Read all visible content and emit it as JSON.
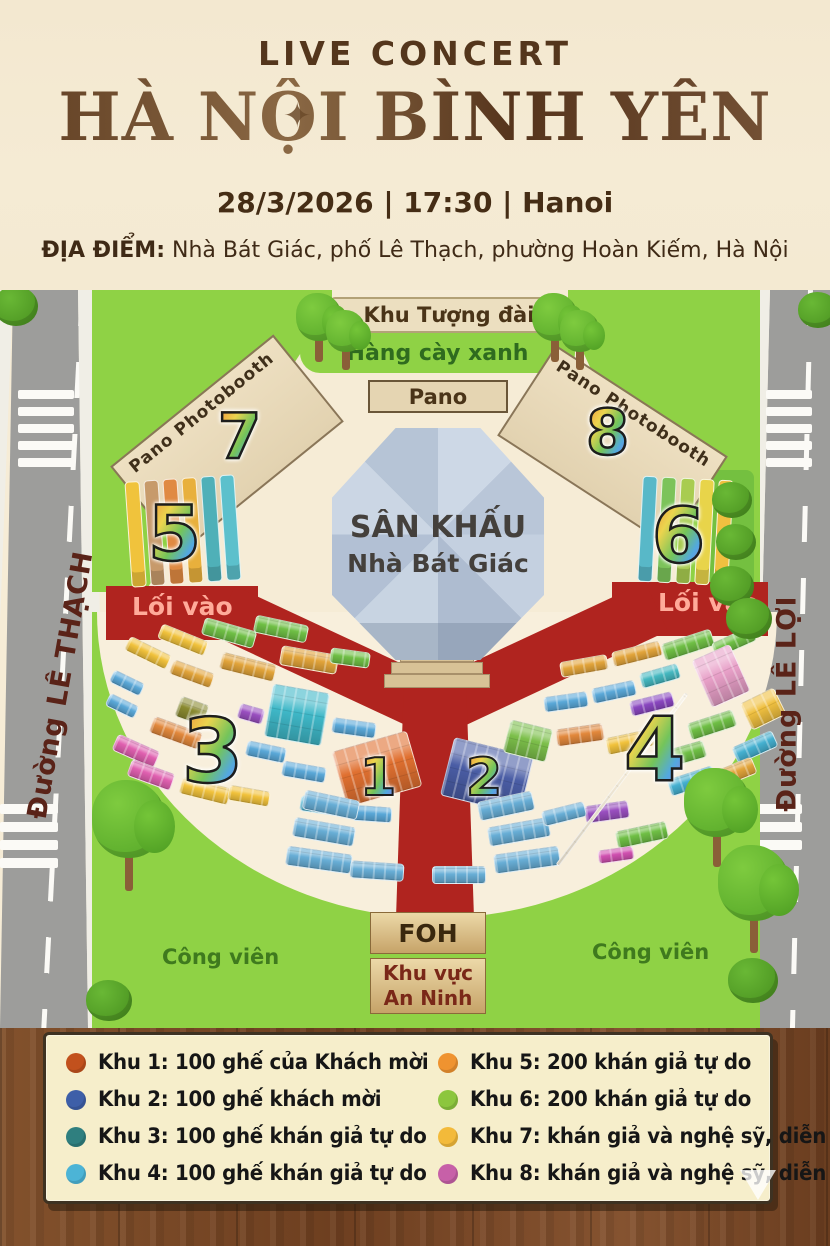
{
  "header": {
    "pretitle": "LIVE CONCERT",
    "title": "HÀ NỘI BÌNH YÊN",
    "datetime": "28/3/2026 | 17:30 | Hanoi",
    "venue_label": "ĐỊA ĐIỂM:",
    "venue": " Nhà Bát Giác, phố Lê Thạch, phường Hoàn Kiếm, Hà Nội"
  },
  "icons": {
    "compass_star": "✦"
  },
  "map": {
    "monument": "Khu Tượng đài",
    "trees_row": "Hàng cày xanh",
    "pano": "Pano",
    "booth_label": "Pano Photobooth",
    "stage1": "SÂN KHẤU",
    "stage2": "Nhà Bát Giác",
    "entrance": "Lối vào",
    "street_left": "Đường LÊ THẠCH",
    "street_right": "Đường LÊ LỢI",
    "foh": "FOH",
    "security1": "Khu vực",
    "security2": "An Ninh",
    "park": "Công viên",
    "zones": {
      "z1": "1",
      "z2": "2",
      "z3": "3",
      "z4": "4",
      "z5": "5",
      "z6": "6",
      "z7": "7",
      "z8": "8"
    },
    "bars5_colors": [
      "#f0c33c",
      "#c79a6b",
      "#e08a42",
      "#e8b03c",
      "#4fb0b8",
      "#5cc0cc"
    ],
    "bars6_colors": [
      "#58b8c8",
      "#7cc35a",
      "#a8cc50",
      "#e8d44a",
      "#f0c040"
    ],
    "seats": [
      {
        "x": 125,
        "y": 355,
        "w": 46,
        "h": 16,
        "r": 26,
        "c": "#f1c23c"
      },
      {
        "x": 158,
        "y": 342,
        "w": 50,
        "h": 16,
        "r": 22,
        "c": "#f1c23c"
      },
      {
        "x": 202,
        "y": 334,
        "w": 54,
        "h": 18,
        "r": 16,
        "c": "#6fbf45"
      },
      {
        "x": 254,
        "y": 330,
        "w": 54,
        "h": 18,
        "r": 12,
        "c": "#6fbf45"
      },
      {
        "x": 110,
        "y": 386,
        "w": 34,
        "h": 14,
        "r": 26,
        "c": "#5aa8d8"
      },
      {
        "x": 106,
        "y": 409,
        "w": 32,
        "h": 14,
        "r": 26,
        "c": "#5aa8d8"
      },
      {
        "x": 170,
        "y": 376,
        "w": 44,
        "h": 16,
        "r": 20,
        "c": "#e2a43a"
      },
      {
        "x": 220,
        "y": 368,
        "w": 56,
        "h": 18,
        "r": 14,
        "c": "#e2a43a"
      },
      {
        "x": 280,
        "y": 360,
        "w": 58,
        "h": 20,
        "r": 10,
        "c": "#e2a43a"
      },
      {
        "x": 177,
        "y": 410,
        "w": 30,
        "h": 22,
        "r": 20,
        "c": "#8a8a30"
      },
      {
        "x": 238,
        "y": 416,
        "w": 26,
        "h": 16,
        "r": 16,
        "c": "#9a4fc0"
      },
      {
        "x": 268,
        "y": 398,
        "w": 58,
        "h": 54,
        "r": 10,
        "c": "#3fb8c8"
      },
      {
        "x": 150,
        "y": 434,
        "w": 52,
        "h": 18,
        "r": 20,
        "c": "#e2883c"
      },
      {
        "x": 113,
        "y": 452,
        "w": 46,
        "h": 18,
        "r": 24,
        "c": "#e060b0"
      },
      {
        "x": 128,
        "y": 476,
        "w": 46,
        "h": 18,
        "r": 20,
        "c": "#e060b0"
      },
      {
        "x": 180,
        "y": 492,
        "w": 50,
        "h": 18,
        "r": 14,
        "c": "#f1c23c"
      },
      {
        "x": 228,
        "y": 498,
        "w": 42,
        "h": 16,
        "r": 10,
        "c": "#f1c23c"
      },
      {
        "x": 246,
        "y": 454,
        "w": 40,
        "h": 16,
        "r": 12,
        "c": "#5aa8d8"
      },
      {
        "x": 282,
        "y": 474,
        "w": 44,
        "h": 16,
        "r": 10,
        "c": "#5aa8d8"
      },
      {
        "x": 330,
        "y": 360,
        "w": 40,
        "h": 16,
        "r": 8,
        "c": "#6fbf45"
      },
      {
        "x": 332,
        "y": 430,
        "w": 44,
        "h": 16,
        "r": 8,
        "c": "#5aa8d8"
      },
      {
        "x": 336,
        "y": 462,
        "w": 48,
        "h": 18,
        "r": 6,
        "c": "#5aa8d8"
      },
      {
        "x": 300,
        "y": 508,
        "w": 44,
        "h": 16,
        "r": 8,
        "c": "#45b0d0"
      },
      {
        "x": 352,
        "y": 516,
        "w": 40,
        "h": 16,
        "r": 4,
        "c": "#5aa8d8"
      },
      {
        "x": 338,
        "y": 450,
        "w": 78,
        "h": 58,
        "r": -16,
        "c": "#e07030"
      },
      {
        "x": 446,
        "y": 456,
        "w": 82,
        "h": 60,
        "r": 14,
        "c": "#4a5da5"
      },
      {
        "x": 506,
        "y": 434,
        "w": 44,
        "h": 34,
        "r": 14,
        "c": "#7cbf4a"
      },
      {
        "x": 560,
        "y": 368,
        "w": 48,
        "h": 16,
        "r": -10,
        "c": "#e2a43a"
      },
      {
        "x": 612,
        "y": 356,
        "w": 50,
        "h": 16,
        "r": -14,
        "c": "#e2a43a"
      },
      {
        "x": 662,
        "y": 346,
        "w": 52,
        "h": 18,
        "r": -18,
        "c": "#6fbf45"
      },
      {
        "x": 712,
        "y": 344,
        "w": 44,
        "h": 16,
        "r": -24,
        "c": "#6fbf45"
      },
      {
        "x": 700,
        "y": 360,
        "w": 42,
        "h": 52,
        "r": -24,
        "c": "#e8a0c8"
      },
      {
        "x": 744,
        "y": 404,
        "w": 38,
        "h": 30,
        "r": -26,
        "c": "#f0c040"
      },
      {
        "x": 544,
        "y": 404,
        "w": 44,
        "h": 16,
        "r": -8,
        "c": "#5aa8d8"
      },
      {
        "x": 592,
        "y": 394,
        "w": 44,
        "h": 16,
        "r": -12,
        "c": "#5aa8d8"
      },
      {
        "x": 640,
        "y": 378,
        "w": 40,
        "h": 16,
        "r": -16,
        "c": "#45b8c0"
      },
      {
        "x": 630,
        "y": 406,
        "w": 44,
        "h": 16,
        "r": -14,
        "c": "#8a47c0"
      },
      {
        "x": 688,
        "y": 426,
        "w": 48,
        "h": 18,
        "r": -18,
        "c": "#6fbf45"
      },
      {
        "x": 733,
        "y": 448,
        "w": 44,
        "h": 18,
        "r": -24,
        "c": "#45b0d0"
      },
      {
        "x": 556,
        "y": 436,
        "w": 48,
        "h": 18,
        "r": -8,
        "c": "#e2883c"
      },
      {
        "x": 606,
        "y": 443,
        "w": 48,
        "h": 18,
        "r": -12,
        "c": "#f1c23c"
      },
      {
        "x": 658,
        "y": 456,
        "w": 48,
        "h": 18,
        "r": -16,
        "c": "#6fbf45"
      },
      {
        "x": 585,
        "y": 513,
        "w": 44,
        "h": 18,
        "r": -8,
        "c": "#9a4fc0"
      },
      {
        "x": 616,
        "y": 536,
        "w": 52,
        "h": 18,
        "r": -12,
        "c": "#6fbf45"
      },
      {
        "x": 668,
        "y": 482,
        "w": 48,
        "h": 18,
        "r": -18,
        "c": "#45b0d0"
      },
      {
        "x": 712,
        "y": 474,
        "w": 44,
        "h": 18,
        "r": -22,
        "c": "#e2a43a"
      },
      {
        "x": 598,
        "y": 558,
        "w": 36,
        "h": 14,
        "r": -8,
        "c": "#d050b0"
      },
      {
        "x": 303,
        "y": 505,
        "w": 56,
        "h": 20,
        "r": 12,
        "c": "#68aed6"
      },
      {
        "x": 293,
        "y": 532,
        "w": 62,
        "h": 20,
        "r": 10,
        "c": "#68aed6"
      },
      {
        "x": 286,
        "y": 560,
        "w": 66,
        "h": 20,
        "r": 8,
        "c": "#68aed6"
      },
      {
        "x": 350,
        "y": 572,
        "w": 54,
        "h": 18,
        "r": 4,
        "c": "#68aed6"
      },
      {
        "x": 478,
        "y": 506,
        "w": 56,
        "h": 20,
        "r": -12,
        "c": "#68aed6"
      },
      {
        "x": 488,
        "y": 532,
        "w": 62,
        "h": 20,
        "r": -10,
        "c": "#68aed6"
      },
      {
        "x": 494,
        "y": 560,
        "w": 66,
        "h": 20,
        "r": -8,
        "c": "#68aed6"
      },
      {
        "x": 432,
        "y": 576,
        "w": 54,
        "h": 18,
        "r": 0,
        "c": "#68aed6"
      },
      {
        "x": 542,
        "y": 516,
        "w": 44,
        "h": 16,
        "r": -14,
        "c": "#68aed6"
      },
      {
        "x": 620,
        "y": 382,
        "w": 4,
        "h": 215,
        "r": 37,
        "c": "#efe3c8"
      }
    ],
    "trees": [
      {
        "x": 296,
        "y": 3,
        "s": 46
      },
      {
        "x": 326,
        "y": 20,
        "s": 40
      },
      {
        "x": 532,
        "y": 3,
        "s": 46
      },
      {
        "x": 560,
        "y": 20,
        "s": 40
      },
      {
        "x": 92,
        "y": 490,
        "s": 74
      },
      {
        "x": 684,
        "y": 478,
        "s": 66
      },
      {
        "x": 718,
        "y": 555,
        "s": 72
      }
    ],
    "bushes": [
      {
        "x": -6,
        "y": -4,
        "s": 44
      },
      {
        "x": 798,
        "y": 2,
        "s": 40
      },
      {
        "x": 712,
        "y": 192,
        "s": 40
      },
      {
        "x": 716,
        "y": 234,
        "s": 40
      },
      {
        "x": 710,
        "y": 276,
        "s": 44
      },
      {
        "x": 726,
        "y": 308,
        "s": 46
      },
      {
        "x": 86,
        "y": 690,
        "s": 46
      },
      {
        "x": 728,
        "y": 668,
        "s": 50
      }
    ]
  },
  "legend": {
    "items": [
      {
        "color": "#c2511d",
        "text": "Khu 1: 100 ghế của Khách mời"
      },
      {
        "color": "#3e5fa8",
        "text": "Khu 2: 100 ghế khách mời"
      },
      {
        "color": "#2f7f7f",
        "text": "Khu 3: 100 ghế khán giả tự do"
      },
      {
        "color": "#4cb4d6",
        "text": "Khu 4: 100 ghế khán giả tự do"
      },
      {
        "color": "#ef9330",
        "text": "Khu 5: 200 khán giả tự do"
      },
      {
        "color": "#8cc63e",
        "text": "Khu 6: 200 khán giả tự do"
      },
      {
        "color": "#f3ba3a",
        "text": "Khu 7:  khán giả và nghệ sỹ, diễn viên"
      },
      {
        "color": "#c760a8",
        "text": "Khu 8:  khán giả và nghệ sỹ, diễn viên"
      }
    ]
  },
  "colors": {
    "walkway_red": "#b0241f",
    "park_green": "#8fd245",
    "plaza_cream": "#f6ecd6",
    "wood_brown": "#7c4a27",
    "title_brown": "#5f3d22"
  }
}
